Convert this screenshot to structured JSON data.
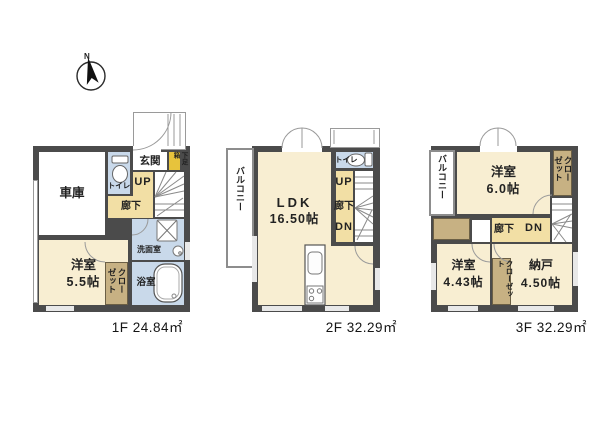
{
  "compass": {
    "north_label": "N"
  },
  "colors": {
    "wall": "#4b4b4b",
    "room_cream": "#f8eed2",
    "hall_tan": "#f2dfa5",
    "wet_area_blue": "#c9d9ea",
    "closet_khaki": "#c7b183",
    "shoebox_yellow": "#e7c33c"
  },
  "floors": [
    {
      "name": "1F",
      "area_label": "1F 24.84㎡",
      "labels": {
        "garage": "車庫",
        "entrance": "玄関",
        "shoe_box": "下足箱",
        "toilet": "トイレ",
        "up": "UP",
        "hallway": "廊下",
        "washroom": "洗面室",
        "bathroom": "浴室",
        "bedroom_name": "洋室",
        "bedroom_size": "5.5帖",
        "closet": "クローゼット"
      }
    },
    {
      "name": "2F",
      "area_label": "2F 32.29㎡",
      "labels": {
        "balcony": "バルコニー",
        "ldk_name": "LDK",
        "ldk_size": "16.50帖",
        "toilet": "トイレ",
        "up": "UP",
        "hallway": "廊下",
        "down": "DN"
      }
    },
    {
      "name": "3F",
      "area_label": "3F 32.29㎡",
      "labels": {
        "balcony": "バルコニー",
        "bedroom6_name": "洋室",
        "bedroom6_size": "6.0帖",
        "closet_top": "クローゼット",
        "hallway": "廊下",
        "down": "DN",
        "bedroom4_name": "洋室",
        "bedroom4_size": "4.43帖",
        "closet_mid": "クローゼット",
        "storage_name": "納戸",
        "storage_size": "4.50帖"
      }
    }
  ]
}
